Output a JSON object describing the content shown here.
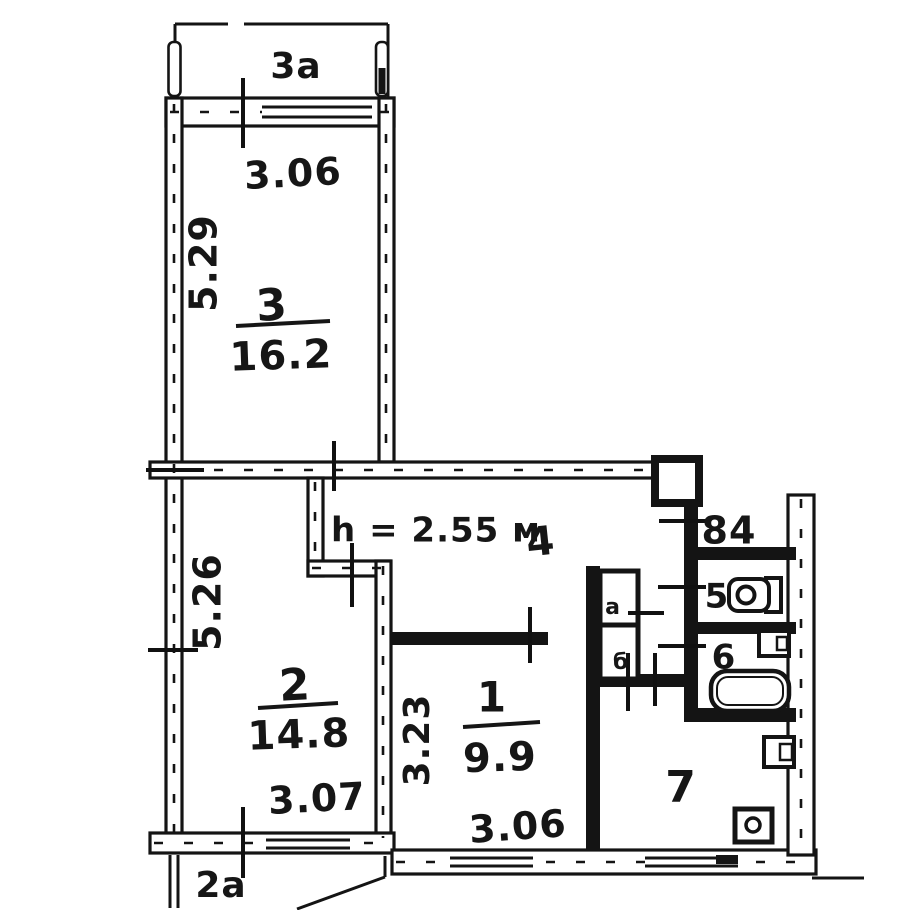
{
  "floor_plan": {
    "ceiling_height_note": "h = 2.55 м",
    "apartment_number": "84",
    "colors": {
      "ink": "#141414",
      "paper": "#ffffff"
    },
    "balcony_top": {
      "label": "3а"
    },
    "balcony_bottom": {
      "label": "2а"
    },
    "rooms": {
      "r1": {
        "number": "1",
        "area": "9.9"
      },
      "r2": {
        "number": "2",
        "area": "14.8"
      },
      "r3": {
        "number": "3",
        "area": "16.2"
      },
      "r4": {
        "number": "4"
      },
      "r5": {
        "number": "5"
      },
      "r6": {
        "number": "6"
      },
      "r7": {
        "number": "7"
      }
    },
    "closets": {
      "a": "а",
      "b": "б"
    },
    "dimensions": {
      "room3_width": "3.06",
      "room3_depth": "5.29",
      "room2_width": "3.07",
      "room2_depth": "5.26",
      "room1_width": "3.06",
      "room1_depth": "3.23"
    }
  }
}
